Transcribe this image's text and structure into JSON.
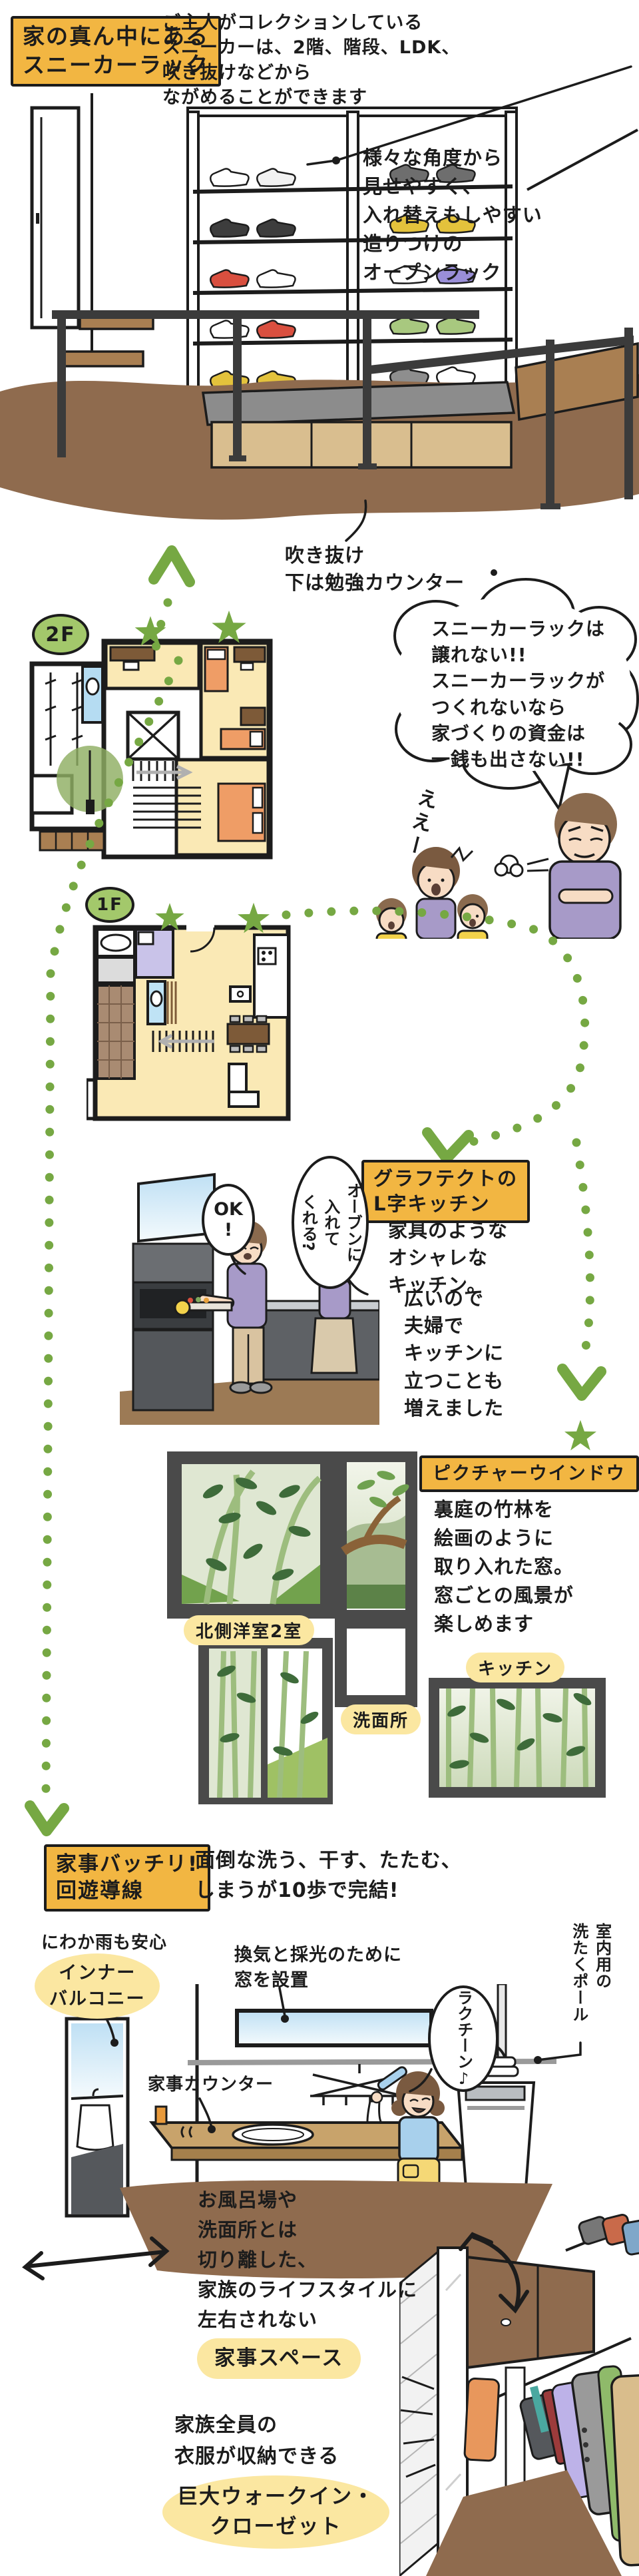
{
  "palette": {
    "accent_green": "#76A843",
    "label_orange": "#F2B642",
    "highlight_yellow": "#FBE7A1",
    "room_yellow": "#FAE9B5",
    "wood_brown": "#8F6B4E"
  },
  "sneaker": {
    "title": "家の真ん中にある\nスニーカーラック",
    "intro": "ご主人がコレクションしている\nスニーカーは、2階、階段、LDK、\n吹き抜けなどから\nながめることができます",
    "rack_note": "様々な角度から\n見せやすく、\n入れ替えもしやすい\n造りつけの\nオープンラック",
    "void_note": "吹き抜け\n下は勉強カウンター"
  },
  "floors": {
    "f2_label": "2F",
    "f1_label": "1F"
  },
  "argument": {
    "dad_bubble": "スニーカーラックは\n譲れない!!\nスニーカーラックが\nつくれないなら\n家づくりの資金は\n一銭も出さない!!",
    "family_react": "ええー"
  },
  "kitchen": {
    "title": "グラフテクトの\nL字キッチン",
    "body1": "家具のような\nオシャレな\nキッチン。",
    "body2": "広いので\n夫婦で\nキッチンに\n立つことも\n増えました",
    "bubble_ask": "オーブンに\n入れて\nくれる?",
    "bubble_ok": "OK\n!"
  },
  "windows": {
    "title": "ピクチャーウインドウ",
    "body": "裏庭の竹林を\n絵画のように\n取り入れた窓。\n窓ごとの風景が\n楽しめます",
    "label_rooms": "北側洋室2室",
    "label_wash": "洗面所",
    "label_kitchen": "キッチン"
  },
  "laundry": {
    "title": "家事バッチリ!\n回遊導線",
    "lead": "面倒な洗う、干す、たたむ、\nしまうが10歩で完結!",
    "balcony_note": "にわか雨も安心",
    "balcony_label": "インナー\nバルコニー",
    "window_note": "換気と採光のために\n窓を設置",
    "pole_label": "室内用の\n洗たくポール",
    "bubble_easy": "ラクチーン♪",
    "counter_label": "家事カウンター",
    "space_note": "お風呂場や\n洗面所とは\n切り離した、\n家族のライフスタイルに\n左右されない",
    "space_highlight": "家事スペース"
  },
  "closet": {
    "note": "家族全員の\n衣服が収納できる",
    "highlight": "巨大ウォークイン・\nクローゼット"
  }
}
